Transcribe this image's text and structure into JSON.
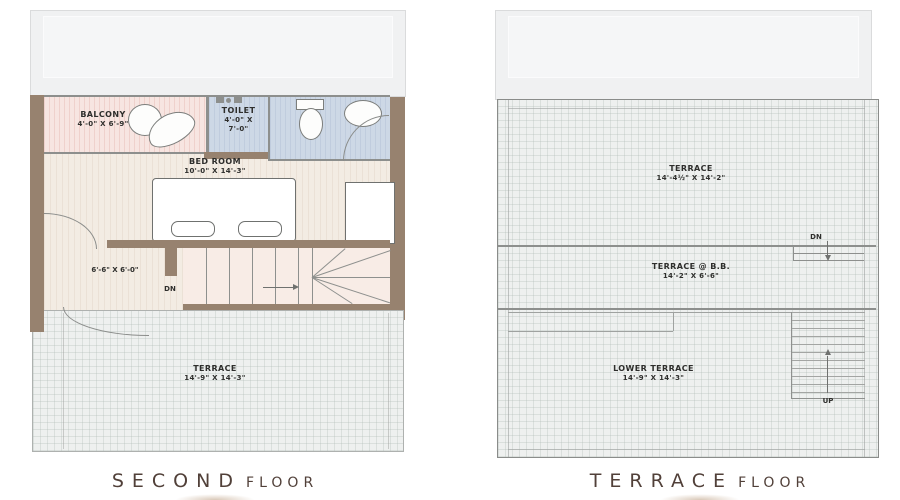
{
  "second_floor": {
    "title": "SECOND",
    "title_suffix": "FLOOR",
    "balcony_name": "BALCONY",
    "balcony_dim": "4'-0\" X 6'-9\"",
    "toilet_name": "TOILET",
    "toilet_dim_line1": "4'-0\" X",
    "toilet_dim_line2": "7'-0\"",
    "bedroom_name": "BED ROOM",
    "bedroom_dim": "10'-0\" X 14'-3\"",
    "hall_dim": "6'-6\" X 6'-0\"",
    "stairs_direction": "DN",
    "terrace_name": "TERRACE",
    "terrace_dim": "14'-9\" X 14'-3\""
  },
  "terrace_floor": {
    "title": "TERRACE",
    "title_suffix": "FLOOR",
    "terrace_name": "TERRACE",
    "terrace_dim": "14'-4½\" X 14'-2\"",
    "terrace_bb_name": "TERRACE @ B.B.",
    "terrace_bb_dim": "14'-2\" X 6'-6\"",
    "lower_terrace_name": "LOWER TERRACE",
    "lower_terrace_dim": "14'-9\" X 14'-3\"",
    "dn_label": "DN",
    "up_label": "UP"
  },
  "colors": {
    "wall_brown": "#97826f",
    "balcony_pink": "#f7e5e1",
    "toilet_blue": "#cdd8e6",
    "floor_cream": "#f3ece3",
    "stairs_pink": "#f8ece6",
    "terrace_gray": "#eef0ef",
    "line_dark": "#8d8f8d",
    "text_dark": "#2e2e2c",
    "title_brown": "#514039"
  }
}
